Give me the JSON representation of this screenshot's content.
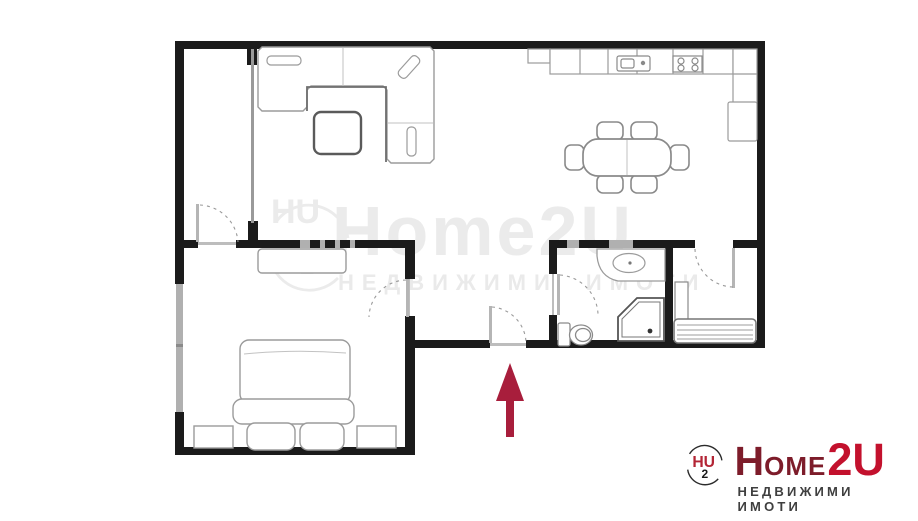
{
  "brand": {
    "emblem": {
      "hu": "HU",
      "two": "2"
    },
    "word_h": "H",
    "word_ome": "OME",
    "word_2u": "2U",
    "tagline": "НЕДВИЖИМИ ИМОТИ",
    "colors": {
      "dark_red": "#7d1c2a",
      "bright_red": "#c3112d",
      "tagline_gray": "#3f3f3f"
    }
  },
  "watermark": {
    "word": "Home2U",
    "tagline": "НЕДВИЖИМИ ИМОТИ",
    "emblem": {
      "hu": "HU",
      "two": "2"
    },
    "color": "#ebebeb"
  },
  "floor_plan": {
    "colors": {
      "wall": "#1b1b1b",
      "window": "#b0b0b0",
      "partition": "#9a9a9a",
      "furniture": "#9b9b9b",
      "furniture_dark": "#6e6e6e",
      "door_arc": "#999999",
      "arrow": "#a81e3c"
    },
    "entrance": {
      "direction": "up"
    },
    "furniture_items": [
      "corner-sofa",
      "coffee-table",
      "dining-table",
      "dining-chairs",
      "kitchen-counter",
      "kitchen-sink",
      "cooktop",
      "refrigerator",
      "double-bed",
      "nightstand",
      "dresser",
      "bathroom-vanity",
      "shower",
      "toilet",
      "cabinet",
      "radiator"
    ]
  }
}
